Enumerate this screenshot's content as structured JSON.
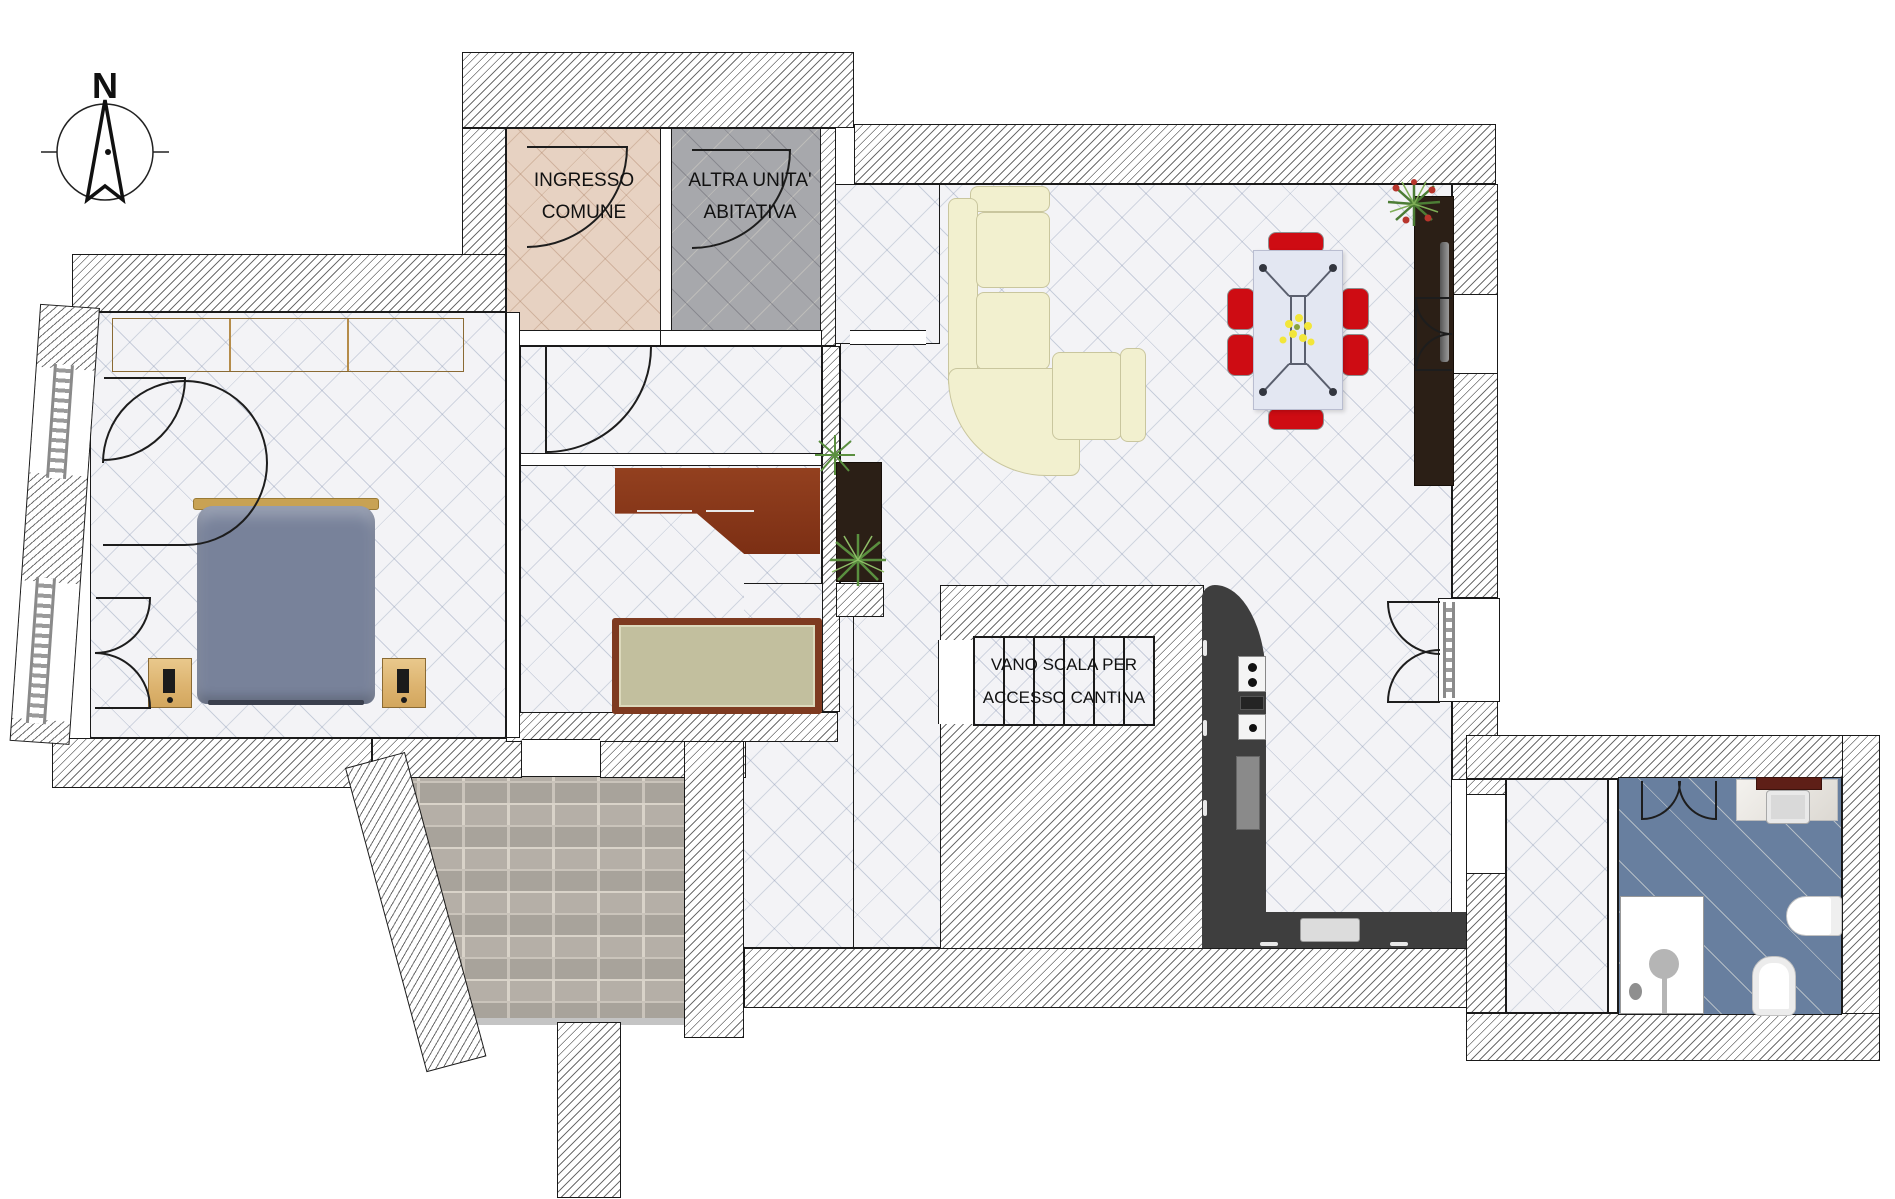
{
  "document": {
    "type": "apartment floor plan",
    "language": "it"
  },
  "compass": {
    "north_label": "N"
  },
  "rooms": {
    "ingresso": {
      "line1": "INGRESSO",
      "line2": "COMUNE"
    },
    "altra_unita": {
      "line1": "ALTRA UNITA'",
      "line2": "ABITATIVA"
    },
    "vano_scala": {
      "line1": "VANO SCALA PER",
      "line2": "ACCESSO CANTINA"
    }
  },
  "colors": {
    "wall_hatch_line": "#6e6e6e",
    "wall_outline": "#1a1a1a",
    "tile_floor": "#f3f3f6",
    "ingresso_floor": "#e7d2c2",
    "altra_floor": "#a7a8ac",
    "bathroom_floor": "#687f9f",
    "terrace_brick": "#b5afa7",
    "wardrobe_wood": "#ddb470",
    "desk_wood": "#8a3a1e",
    "bed_fabric": "#78829a",
    "bed_headboard": "#c8a254",
    "sofa_cream": "#f2f0cf",
    "dining_chair_red": "#ce0c13",
    "dining_table": "#e3e7f2",
    "kitchen_counter": "#3e3e3e",
    "media_cabinet": "#2b1f16",
    "side_table_top": "#c2bf9e",
    "plant_green": "#4c7d35"
  }
}
